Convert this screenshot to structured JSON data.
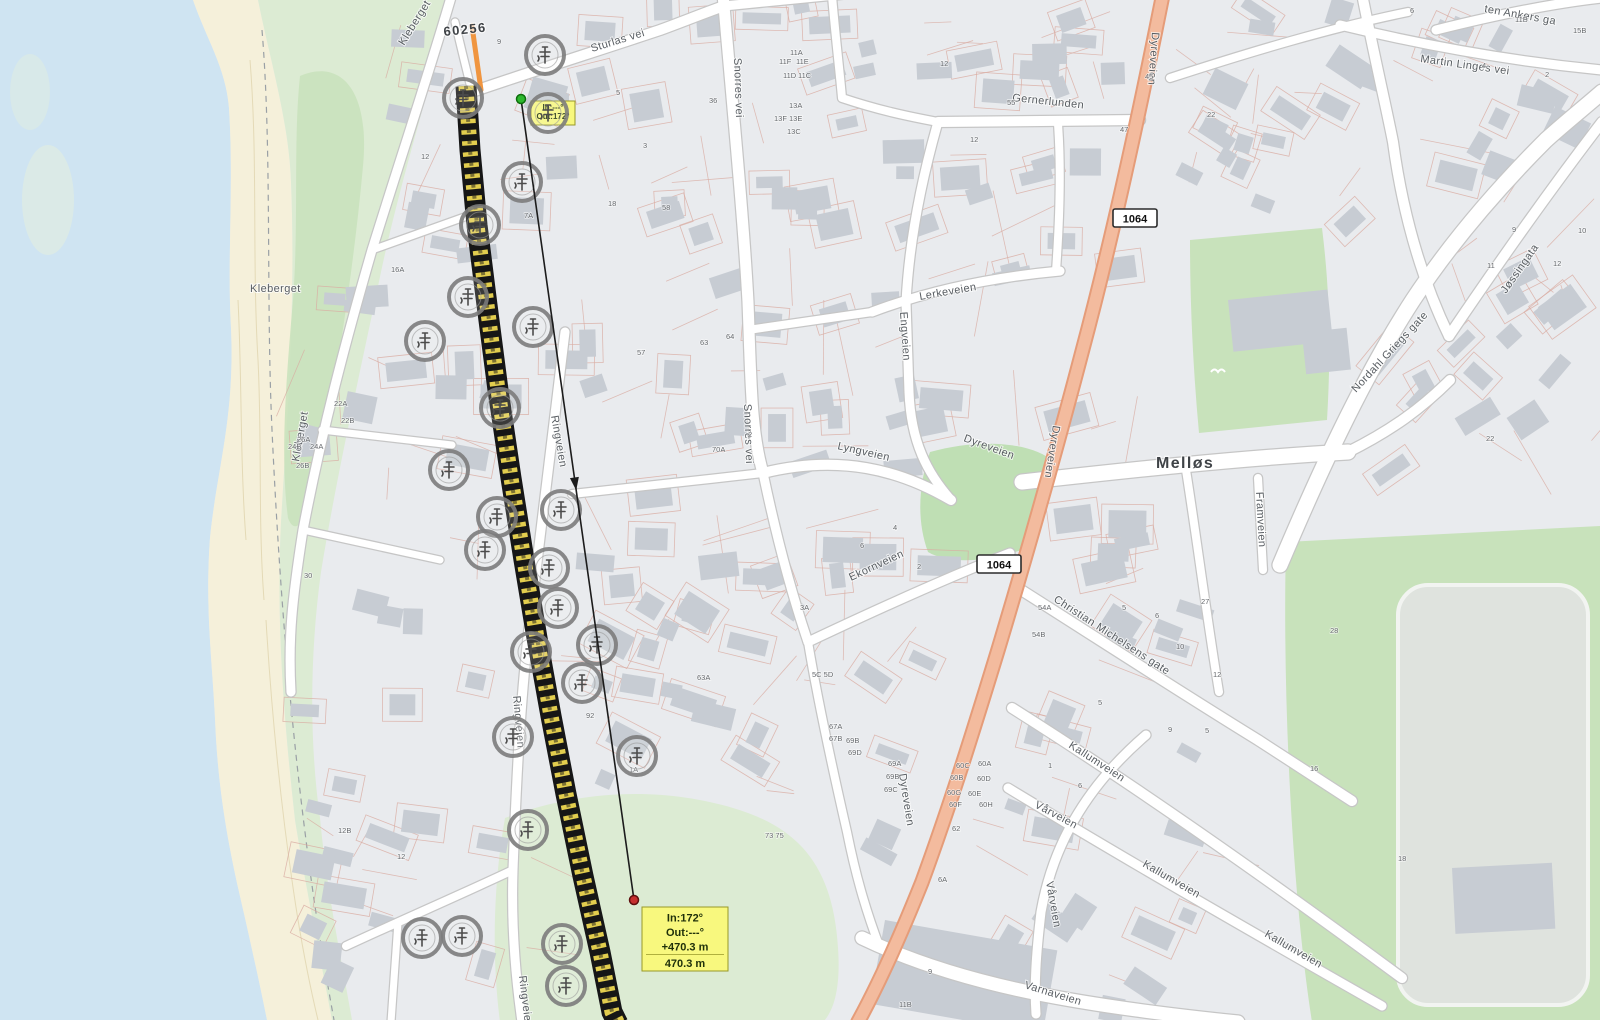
{
  "colors": {
    "water": "#cfe4f2",
    "sand": "#f5f0da",
    "green": "#dcebd3",
    "green_dark": "#c8e2bb",
    "green_park": "#bfdfb4",
    "building": "#c7ccd3",
    "parcel": "#d9aca2",
    "road_casing": "#c6c6c6",
    "road_fill": "#ffffff",
    "salmon_fill": "#f3bb9e",
    "salmon_casing": "#e59c79",
    "route_black": "#161616",
    "route_yellow": "#e2cd4e",
    "highlight_orange": "#f0953f",
    "tooltip_bg": "#f8f87e",
    "tooltip_border": "#98982a",
    "measure_green": "#2eb82e",
    "measure_red": "#c62f2f",
    "label": "#585d62",
    "house_label": "#66696d",
    "place_label": "#3f4347"
  },
  "map": {
    "place_labels": [
      {
        "t": "Melløs",
        "x": 1156,
        "y": 468,
        "r": 0,
        "s": 16
      },
      {
        "t": "60256",
        "x": 444,
        "y": 36,
        "r": -6,
        "s": 13
      }
    ],
    "street_labels": [
      {
        "t": "Sturlas vei",
        "x": 592,
        "y": 52,
        "r": -17,
        "s": 11
      },
      {
        "t": "Snorres vei",
        "x": 734,
        "y": 58,
        "r": 88,
        "s": 11
      },
      {
        "t": "Snorres vei",
        "x": 744,
        "y": 404,
        "r": 88,
        "s": 11
      },
      {
        "t": "Gernerlunden",
        "x": 1012,
        "y": 101,
        "r": 6,
        "s": 11
      },
      {
        "t": "Lerkeveien",
        "x": 920,
        "y": 300,
        "r": -10,
        "s": 11
      },
      {
        "t": "Engveien",
        "x": 900,
        "y": 312,
        "r": 86,
        "s": 11
      },
      {
        "t": "Lyngveien",
        "x": 837,
        "y": 449,
        "r": 13,
        "s": 11
      },
      {
        "t": "Dyreveien",
        "x": 1152,
        "y": 32,
        "r": 94,
        "s": 11
      },
      {
        "t": "Dyreveien",
        "x": 963,
        "y": 441,
        "r": 20,
        "s": 11
      },
      {
        "t": "Dyreveien",
        "x": 1053,
        "y": 425,
        "r": 99,
        "s": 11
      },
      {
        "t": "Dyreveien",
        "x": 899,
        "y": 774,
        "r": 81,
        "s": 11
      },
      {
        "t": "Ekornveien",
        "x": 851,
        "y": 581,
        "r": -25,
        "s": 11
      },
      {
        "t": "Christian Michelsens gate",
        "x": 1053,
        "y": 601,
        "r": 33,
        "s": 11
      },
      {
        "t": "Kallumveien",
        "x": 1068,
        "y": 747,
        "r": 33,
        "s": 11
      },
      {
        "t": "Kallumveien",
        "x": 1142,
        "y": 866,
        "r": 30,
        "s": 11
      },
      {
        "t": "Kallumveien",
        "x": 1264,
        "y": 936,
        "r": 30,
        "s": 11
      },
      {
        "t": "Framveien",
        "x": 1256,
        "y": 492,
        "r": 87,
        "s": 11
      },
      {
        "t": "Vårveien",
        "x": 1034,
        "y": 807,
        "r": 28,
        "s": 11
      },
      {
        "t": "Vårveien",
        "x": 1046,
        "y": 882,
        "r": 80,
        "s": 11
      },
      {
        "t": "Varnaveien",
        "x": 1024,
        "y": 988,
        "r": 17,
        "s": 11
      },
      {
        "t": "Nordahl Griegs gate",
        "x": 1356,
        "y": 393,
        "r": -47,
        "s": 11
      },
      {
        "t": "Jøssingata",
        "x": 1506,
        "y": 294,
        "r": -55,
        "s": 11
      },
      {
        "t": "Martin Linges vei",
        "x": 1420,
        "y": 62,
        "r": 8,
        "s": 11
      },
      {
        "t": "ten Ankers ga",
        "x": 1484,
        "y": 12,
        "r": 10,
        "s": 11
      },
      {
        "t": "Kleberget",
        "x": 250,
        "y": 292,
        "r": 0,
        "s": 11
      },
      {
        "t": "Kleberget",
        "x": 299,
        "y": 462,
        "r": -80,
        "s": 11
      },
      {
        "t": "Kleberget",
        "x": 404,
        "y": 46,
        "r": -58,
        "s": 11
      },
      {
        "t": "Ringveien",
        "x": 551,
        "y": 416,
        "r": 80,
        "s": 11
      },
      {
        "t": "Ringveien",
        "x": 513,
        "y": 696,
        "r": 85,
        "s": 11
      },
      {
        "t": "Ringveien",
        "x": 519,
        "y": 976,
        "r": 83,
        "s": 11
      }
    ],
    "house_numbers": [
      [
        790,
        55,
        "11A"
      ],
      [
        779,
        64,
        "11F"
      ],
      [
        796,
        64,
        "11E"
      ],
      [
        783,
        78,
        "11D"
      ],
      [
        798,
        78,
        "11C"
      ],
      [
        789,
        108,
        "13A"
      ],
      [
        774,
        121,
        "13F"
      ],
      [
        789,
        121,
        "13E"
      ],
      [
        787,
        134,
        "13C"
      ],
      [
        709,
        103,
        "36"
      ],
      [
        616,
        95,
        "5"
      ],
      [
        643,
        148,
        "3"
      ],
      [
        662,
        210,
        "58"
      ],
      [
        608,
        206,
        "18"
      ],
      [
        637,
        355,
        "57"
      ],
      [
        700,
        345,
        "63"
      ],
      [
        726,
        339,
        "64"
      ],
      [
        712,
        452,
        "70A"
      ],
      [
        748,
        437,
        "2"
      ],
      [
        524,
        218,
        "7A"
      ],
      [
        421,
        159,
        "12"
      ],
      [
        391,
        272,
        "16A"
      ],
      [
        334,
        406,
        "22A"
      ],
      [
        341,
        423,
        "22B"
      ],
      [
        288,
        449,
        "24B"
      ],
      [
        310,
        449,
        "24A"
      ],
      [
        297,
        442,
        "26A"
      ],
      [
        296,
        468,
        "26B"
      ],
      [
        304,
        578,
        "30"
      ],
      [
        586,
        718,
        "92"
      ],
      [
        629,
        772,
        "1A"
      ],
      [
        697,
        680,
        "63A"
      ],
      [
        812,
        677,
        "5C 5D"
      ],
      [
        800,
        610,
        "3A"
      ],
      [
        829,
        729,
        "67A"
      ],
      [
        829,
        741,
        "67B"
      ],
      [
        846,
        743,
        "69B"
      ],
      [
        848,
        755,
        "69D"
      ],
      [
        765,
        838,
        "73 75"
      ],
      [
        888,
        766,
        "69A"
      ],
      [
        886,
        779,
        "69B"
      ],
      [
        884,
        792,
        "69C"
      ],
      [
        956,
        768,
        "60C"
      ],
      [
        978,
        766,
        "60A"
      ],
      [
        950,
        780,
        "60B"
      ],
      [
        977,
        781,
        "60D"
      ],
      [
        947,
        795,
        "60G"
      ],
      [
        968,
        796,
        "60E"
      ],
      [
        949,
        807,
        "60F"
      ],
      [
        979,
        807,
        "60H"
      ],
      [
        952,
        831,
        "62"
      ],
      [
        938,
        882,
        "6A"
      ],
      [
        928,
        974,
        "9"
      ],
      [
        899,
        1007,
        "11B"
      ],
      [
        1038,
        610,
        "54A"
      ],
      [
        1032,
        637,
        "54B"
      ],
      [
        1176,
        649,
        "10"
      ],
      [
        1145,
        79,
        "45"
      ],
      [
        1120,
        132,
        "47"
      ],
      [
        1207,
        117,
        "22"
      ],
      [
        1330,
        633,
        "28"
      ],
      [
        1310,
        771,
        "16"
      ],
      [
        1398,
        861,
        "18"
      ],
      [
        1486,
        441,
        "22"
      ],
      [
        338,
        833,
        "12B"
      ],
      [
        397,
        859,
        "12"
      ],
      [
        497,
        44,
        "9"
      ],
      [
        1410,
        13,
        "6"
      ],
      [
        1482,
        68,
        "4"
      ],
      [
        1545,
        77,
        "2"
      ],
      [
        1515,
        22,
        "11B"
      ],
      [
        1573,
        33,
        "15B"
      ],
      [
        1512,
        232,
        "9"
      ],
      [
        1578,
        233,
        "10"
      ],
      [
        1553,
        266,
        "12"
      ],
      [
        1487,
        268,
        "11"
      ],
      [
        860,
        548,
        "6"
      ],
      [
        893,
        530,
        "4"
      ],
      [
        917,
        569,
        "2"
      ],
      [
        1122,
        610,
        "5"
      ],
      [
        1155,
        618,
        "6"
      ],
      [
        1201,
        604,
        "27"
      ],
      [
        1213,
        677,
        "12"
      ],
      [
        1098,
        705,
        "5"
      ],
      [
        1168,
        732,
        "9"
      ],
      [
        1205,
        733,
        "5"
      ],
      [
        1048,
        768,
        "1"
      ],
      [
        1078,
        788,
        "6"
      ],
      [
        940,
        66,
        "12"
      ],
      [
        1007,
        105,
        "55"
      ],
      [
        970,
        142,
        "12"
      ]
    ],
    "road_refs": [
      {
        "t": "1064",
        "x": 1113,
        "y": 209
      },
      {
        "t": "1064",
        "x": 977,
        "y": 555
      }
    ],
    "markers": [
      [
        545,
        55
      ],
      [
        463,
        98
      ],
      [
        548,
        113
      ],
      [
        522,
        182
      ],
      [
        480,
        225
      ],
      [
        468,
        297
      ],
      [
        425,
        341
      ],
      [
        533,
        327
      ],
      [
        500,
        408
      ],
      [
        449,
        470
      ],
      [
        497,
        517
      ],
      [
        561,
        510
      ],
      [
        485,
        550
      ],
      [
        549,
        568
      ],
      [
        558,
        608
      ],
      [
        531,
        652
      ],
      [
        597,
        645
      ],
      [
        582,
        683
      ],
      [
        513,
        737
      ],
      [
        637,
        756
      ],
      [
        528,
        830
      ],
      [
        422,
        938
      ],
      [
        462,
        936
      ],
      [
        562,
        944
      ],
      [
        566,
        986
      ]
    ],
    "cable_route": {
      "points": [
        [
          466,
          86
        ],
        [
          470,
          150
        ],
        [
          477,
          225
        ],
        [
          487,
          305
        ],
        [
          498,
          390
        ],
        [
          511,
          478
        ],
        [
          524,
          560
        ],
        [
          537,
          638
        ],
        [
          551,
          716
        ],
        [
          566,
          794
        ],
        [
          583,
          876
        ],
        [
          600,
          952
        ],
        [
          612,
          1012
        ],
        [
          618,
          1024
        ]
      ],
      "highlight": [
        [
          472,
          26
        ],
        [
          481,
          90
        ]
      ]
    },
    "measurement": {
      "start": {
        "x": 521,
        "y": 99
      },
      "end": {
        "x": 634,
        "y": 900
      },
      "arrow_t": 0.48,
      "start_tooltip": {
        "x": 531,
        "y": 101,
        "w": 44,
        "h": 24,
        "fs": 8,
        "lines": [
          "In:---°",
          "Out:172°"
        ]
      },
      "end_tooltip": {
        "x": 642,
        "y": 907,
        "w": 86,
        "h": 64,
        "fs": 11,
        "lines": [
          "In:172°",
          "Out:---°",
          "+470.3 m",
          "470.3 m"
        ]
      }
    },
    "bird": {
      "x": 1218,
      "y": 372
    }
  }
}
